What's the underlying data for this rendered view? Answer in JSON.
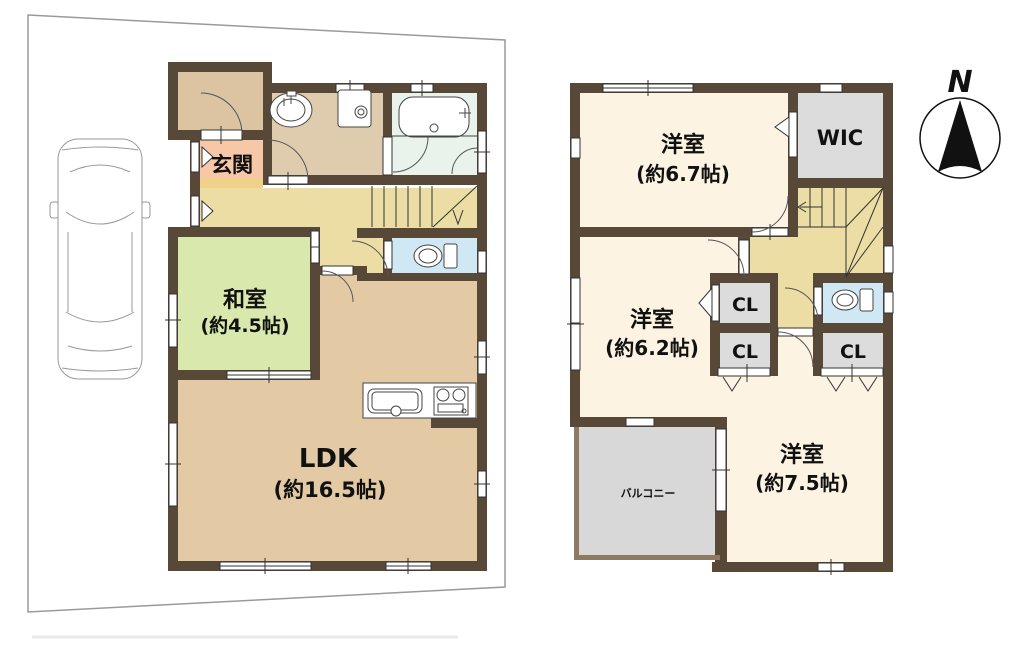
{
  "palette": {
    "wall": "#584838",
    "plot_outline": "#9a9a9a",
    "hall_floor": "#ebdda4",
    "genkan_floor": "#f6c8a8",
    "genkan_step": "#f0d189",
    "porch_floor": "#dcc4a2",
    "washroom_floor": "#dfccae",
    "bath_floor": "#eaf2ec",
    "toilet_floor": "#cfe8f4",
    "washitsu_floor": "#d9e9ad",
    "ldk_floor": "#e3caa5",
    "bedroom_floor": "#fdf3e2",
    "storage_floor": "#dcdcdc",
    "balcony_floor": "#d8d8d8",
    "text": "#111111"
  },
  "floor1": {
    "genkan": "玄関",
    "washitsu": "和室",
    "washitsu_size": "(約4.5帖)",
    "ldk": "LDK",
    "ldk_size": "(約16.5帖)"
  },
  "floor2": {
    "bedroom_a": "洋室",
    "bedroom_a_size": "(約6.7帖)",
    "wic": "WIC",
    "bedroom_b": "洋室",
    "bedroom_b_size": "(約6.2帖)",
    "closet_a": "CL",
    "closet_b": "CL",
    "closet_c": "CL",
    "bedroom_c": "洋室",
    "bedroom_c_size": "(約7.5帖)",
    "balcony": "バルコニー"
  },
  "compass": {
    "north": "N"
  }
}
